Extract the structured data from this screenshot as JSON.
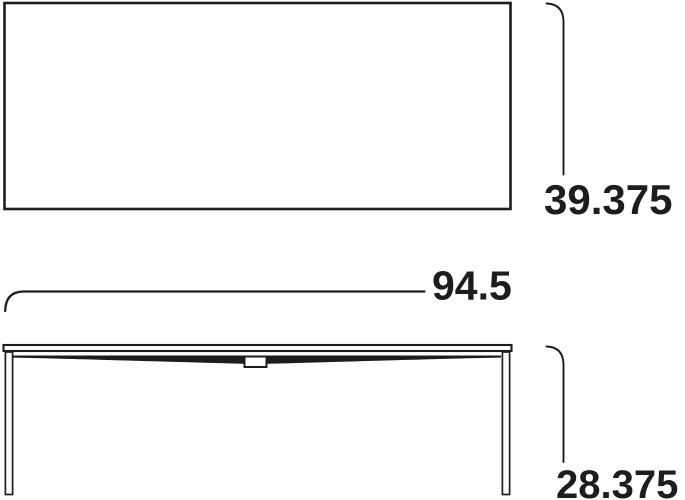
{
  "ink_color": "#1d1d1b",
  "views": {
    "top_view": {
      "depth_dimension": "39.375"
    },
    "front_view": {
      "width_dimension": "94.5",
      "height_dimension": "28.375"
    }
  }
}
